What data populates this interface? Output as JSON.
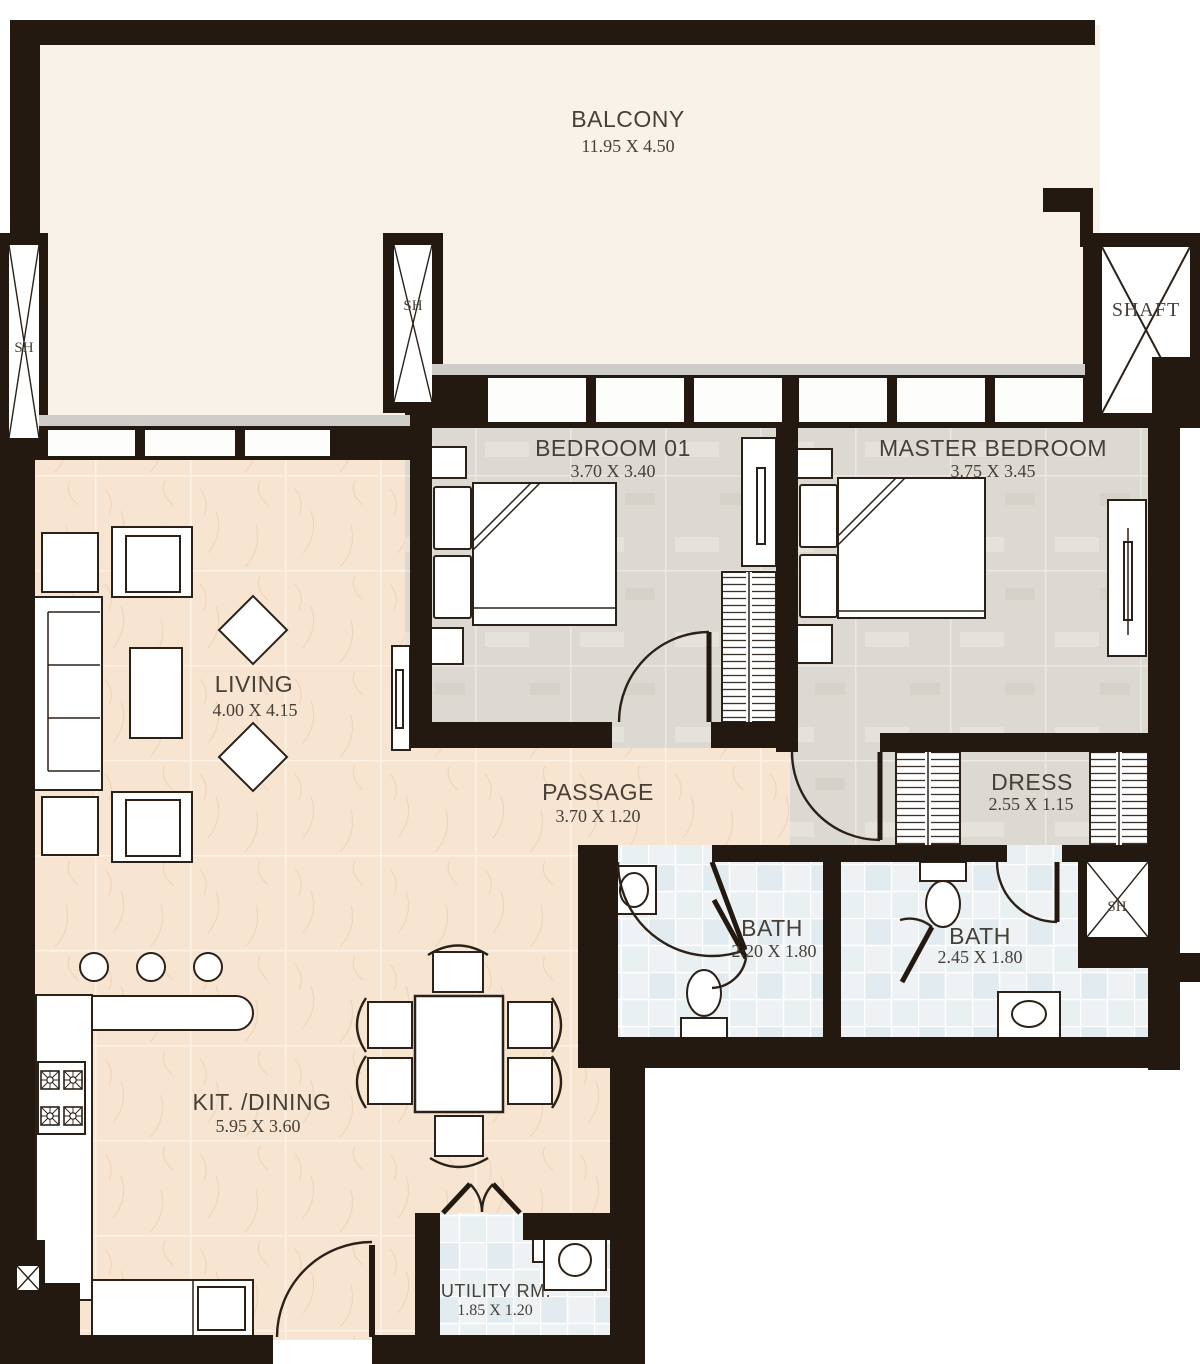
{
  "rooms": {
    "balcony": {
      "name": "BALCONY",
      "dims": "11.95 X 4.50"
    },
    "bedroom01": {
      "name": "BEDROOM 01",
      "dims": "3.70 X 3.40"
    },
    "master_bedroom": {
      "name": "MASTER BEDROOM",
      "dims": "3.75 X 3.45"
    },
    "living": {
      "name": "LIVING",
      "dims": "4.00 X 4.15"
    },
    "passage": {
      "name": "PASSAGE",
      "dims": "3.70 X 1.20"
    },
    "dress": {
      "name": "DRESS",
      "dims": "2.55 X 1.15"
    },
    "bath_1": {
      "name": "BATH",
      "dims": "2.20 X 1.80"
    },
    "bath_2": {
      "name": "BATH",
      "dims": "2.45 X 1.80"
    },
    "kit_dining": {
      "name": "KIT. /DINING",
      "dims": "5.95 X 3.60"
    },
    "utility": {
      "name": "UTILITY RM.",
      "dims": "1.85 X 1.20"
    }
  },
  "shafts": {
    "left_sh": "SH",
    "mid_sh": "SH",
    "top_right_shaft": "SHAFT",
    "right_sh": "SH"
  },
  "colors": {
    "wall": "#241911",
    "balcony_floor": "#f8f2e9",
    "bedroom_floor": "#dcd9d2",
    "living_floor": "#f7e5d2",
    "bath_floor": "#eff2f4",
    "label_text": "#474038"
  }
}
